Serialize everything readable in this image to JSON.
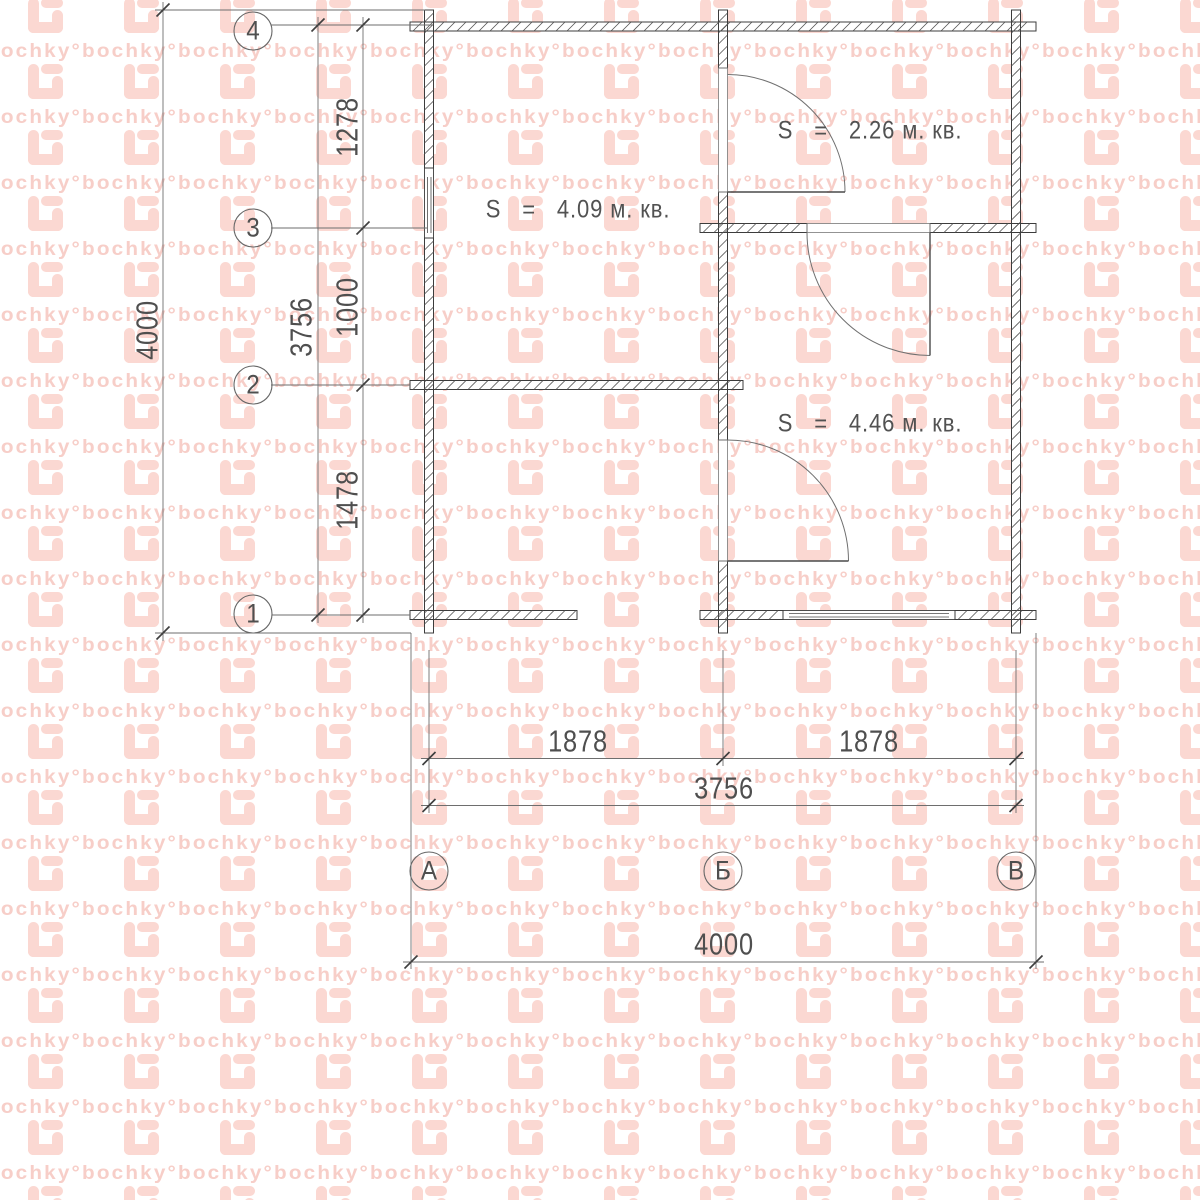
{
  "watermark": {
    "word": "bochky°"
  },
  "colors": {
    "watermark_word": "#f7cec8",
    "watermark_glyph": "#fbd8d2",
    "wall_line": "#3c3c3c",
    "dim_line": "#6e6e6e",
    "text": "#4f4f4f"
  },
  "axes": {
    "rows": [
      {
        "label": "4"
      },
      {
        "label": "3"
      },
      {
        "label": "2"
      },
      {
        "label": "1"
      }
    ],
    "cols": [
      {
        "label": "А"
      },
      {
        "label": "Б"
      },
      {
        "label": "В"
      }
    ]
  },
  "dimensions": {
    "left": {
      "segments": [
        "1278",
        "1000",
        "1478"
      ],
      "subtotal": "3756",
      "overall": "4000"
    },
    "bottom": {
      "segments": [
        "1878",
        "1878"
      ],
      "subtotal": "3756",
      "overall": "4000"
    }
  },
  "rooms": [
    {
      "area_label": "S   =   4.09 м. кв."
    },
    {
      "area_label": "S   =   2.26 м. кв."
    },
    {
      "area_label": "S   =   4.46 м. кв."
    }
  ]
}
